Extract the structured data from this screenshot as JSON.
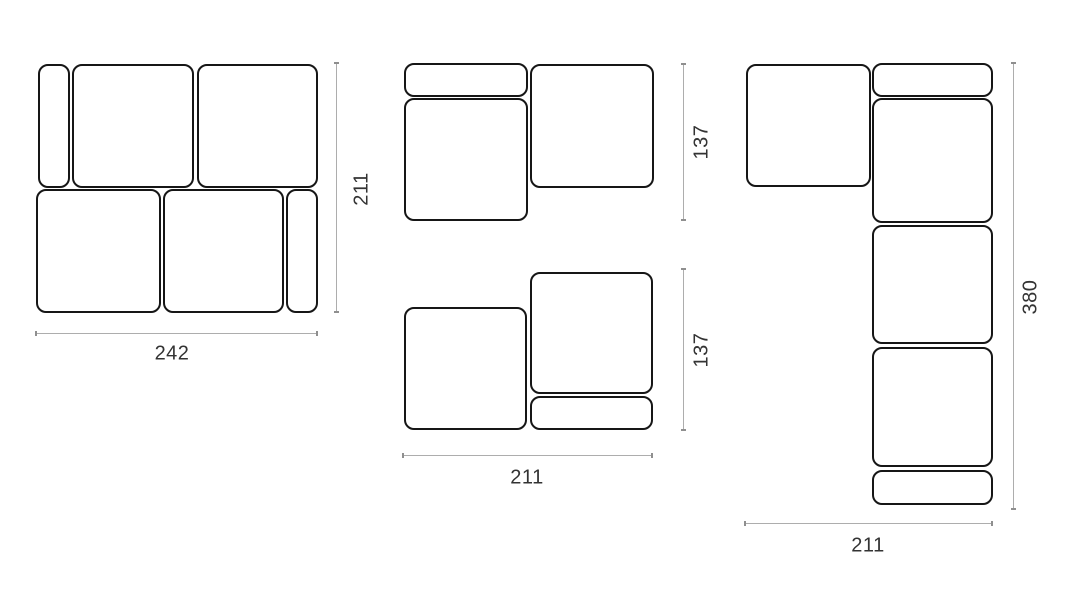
{
  "page": {
    "title": "Modular sofa configuration dimension diagram",
    "background": "#ffffff"
  },
  "colors": {
    "module_outline": "#161616",
    "module_fill": "#ffffff",
    "dimension_line": "#adadad",
    "dimension_tick": "#8f8f8f",
    "label_text": "#333333"
  },
  "units": "cm",
  "diagrams": [
    {
      "id": "config-two-row",
      "description": "Two-row modular sofa top view with side armrests",
      "width_label": "242",
      "height_label": "211"
    },
    {
      "id": "config-chaise-left",
      "description": "Chaise module with backrest and corner seat",
      "height_label": "137"
    },
    {
      "id": "config-chaise-right",
      "description": "Seat with offset corner module and backrest",
      "width_label": "211",
      "height_label": "137"
    },
    {
      "id": "config-l-shape",
      "description": "L-shaped corner sofa with chaise",
      "width_label": "211",
      "height_label": "380"
    }
  ]
}
